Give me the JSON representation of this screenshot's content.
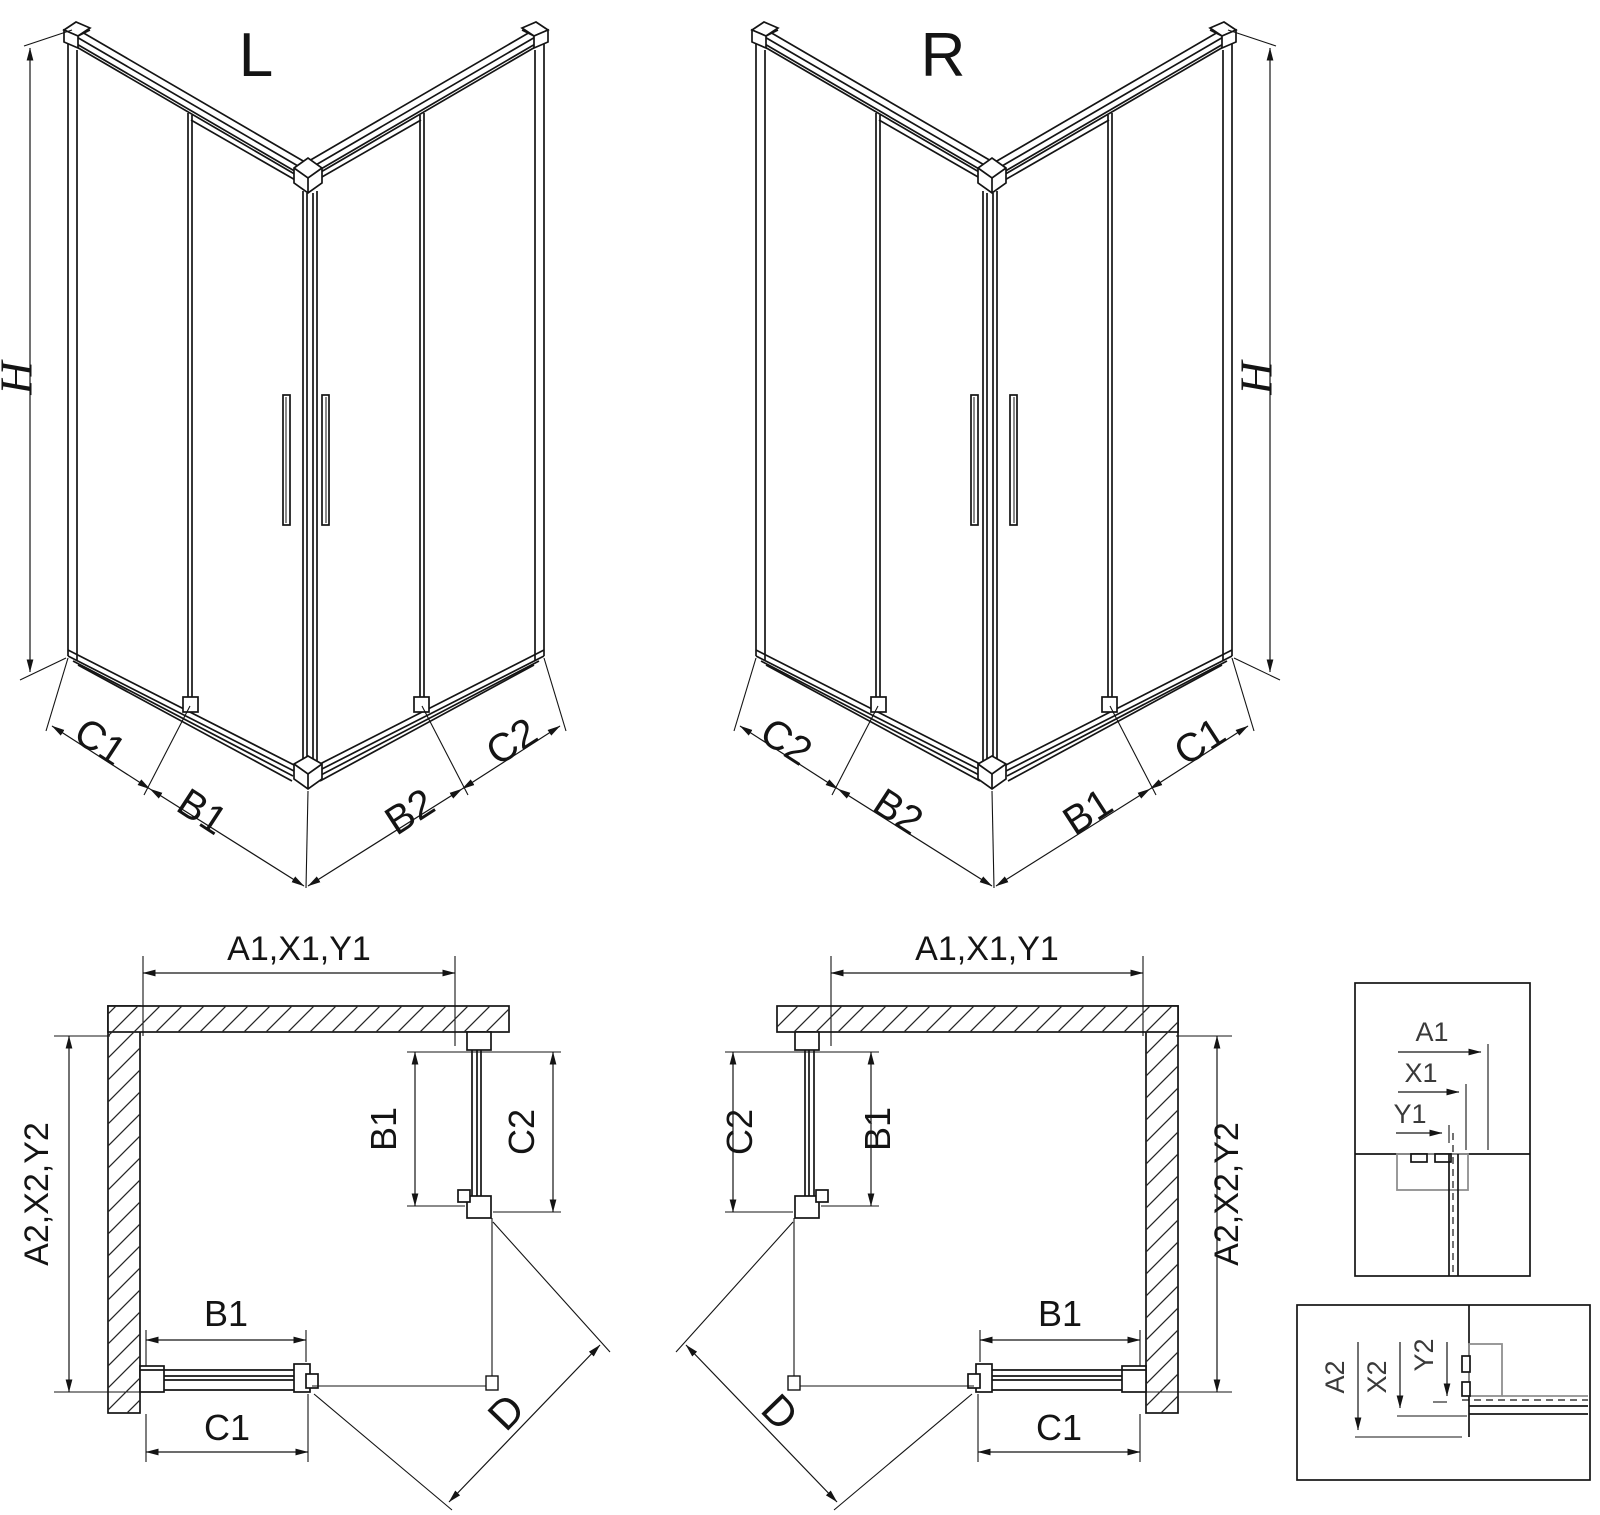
{
  "iso_left": {
    "title": "L",
    "height": "H",
    "outer_left": "C1",
    "inner_left": "B1",
    "inner_right": "B2",
    "outer_right": "C2"
  },
  "iso_right": {
    "title": "R",
    "height": "H",
    "outer_left": "C2",
    "inner_left": "B2",
    "inner_right": "B1",
    "outer_right": "C1"
  },
  "plan_left": {
    "width": "A1,X1,Y1",
    "depth": "A2,X2,Y2",
    "door_side": "B1",
    "panel_side": "C2",
    "door_front": "B1",
    "panel_front": "C1",
    "diagonal": "D"
  },
  "plan_right": {
    "width": "A1,X1,Y1",
    "depth": "A2,X2,Y2",
    "door_side": "B1",
    "panel_side": "C2",
    "door_front": "B1",
    "panel_front": "C1",
    "diagonal": "D"
  },
  "detail_width": {
    "a": "A1",
    "x": "X1",
    "y": "Y1"
  },
  "detail_depth": {
    "a": "A2",
    "x": "X2",
    "y": "Y2"
  },
  "colors": {
    "line": "#141414",
    "profile_gray": "#8f8f8f",
    "background": "#ffffff"
  }
}
